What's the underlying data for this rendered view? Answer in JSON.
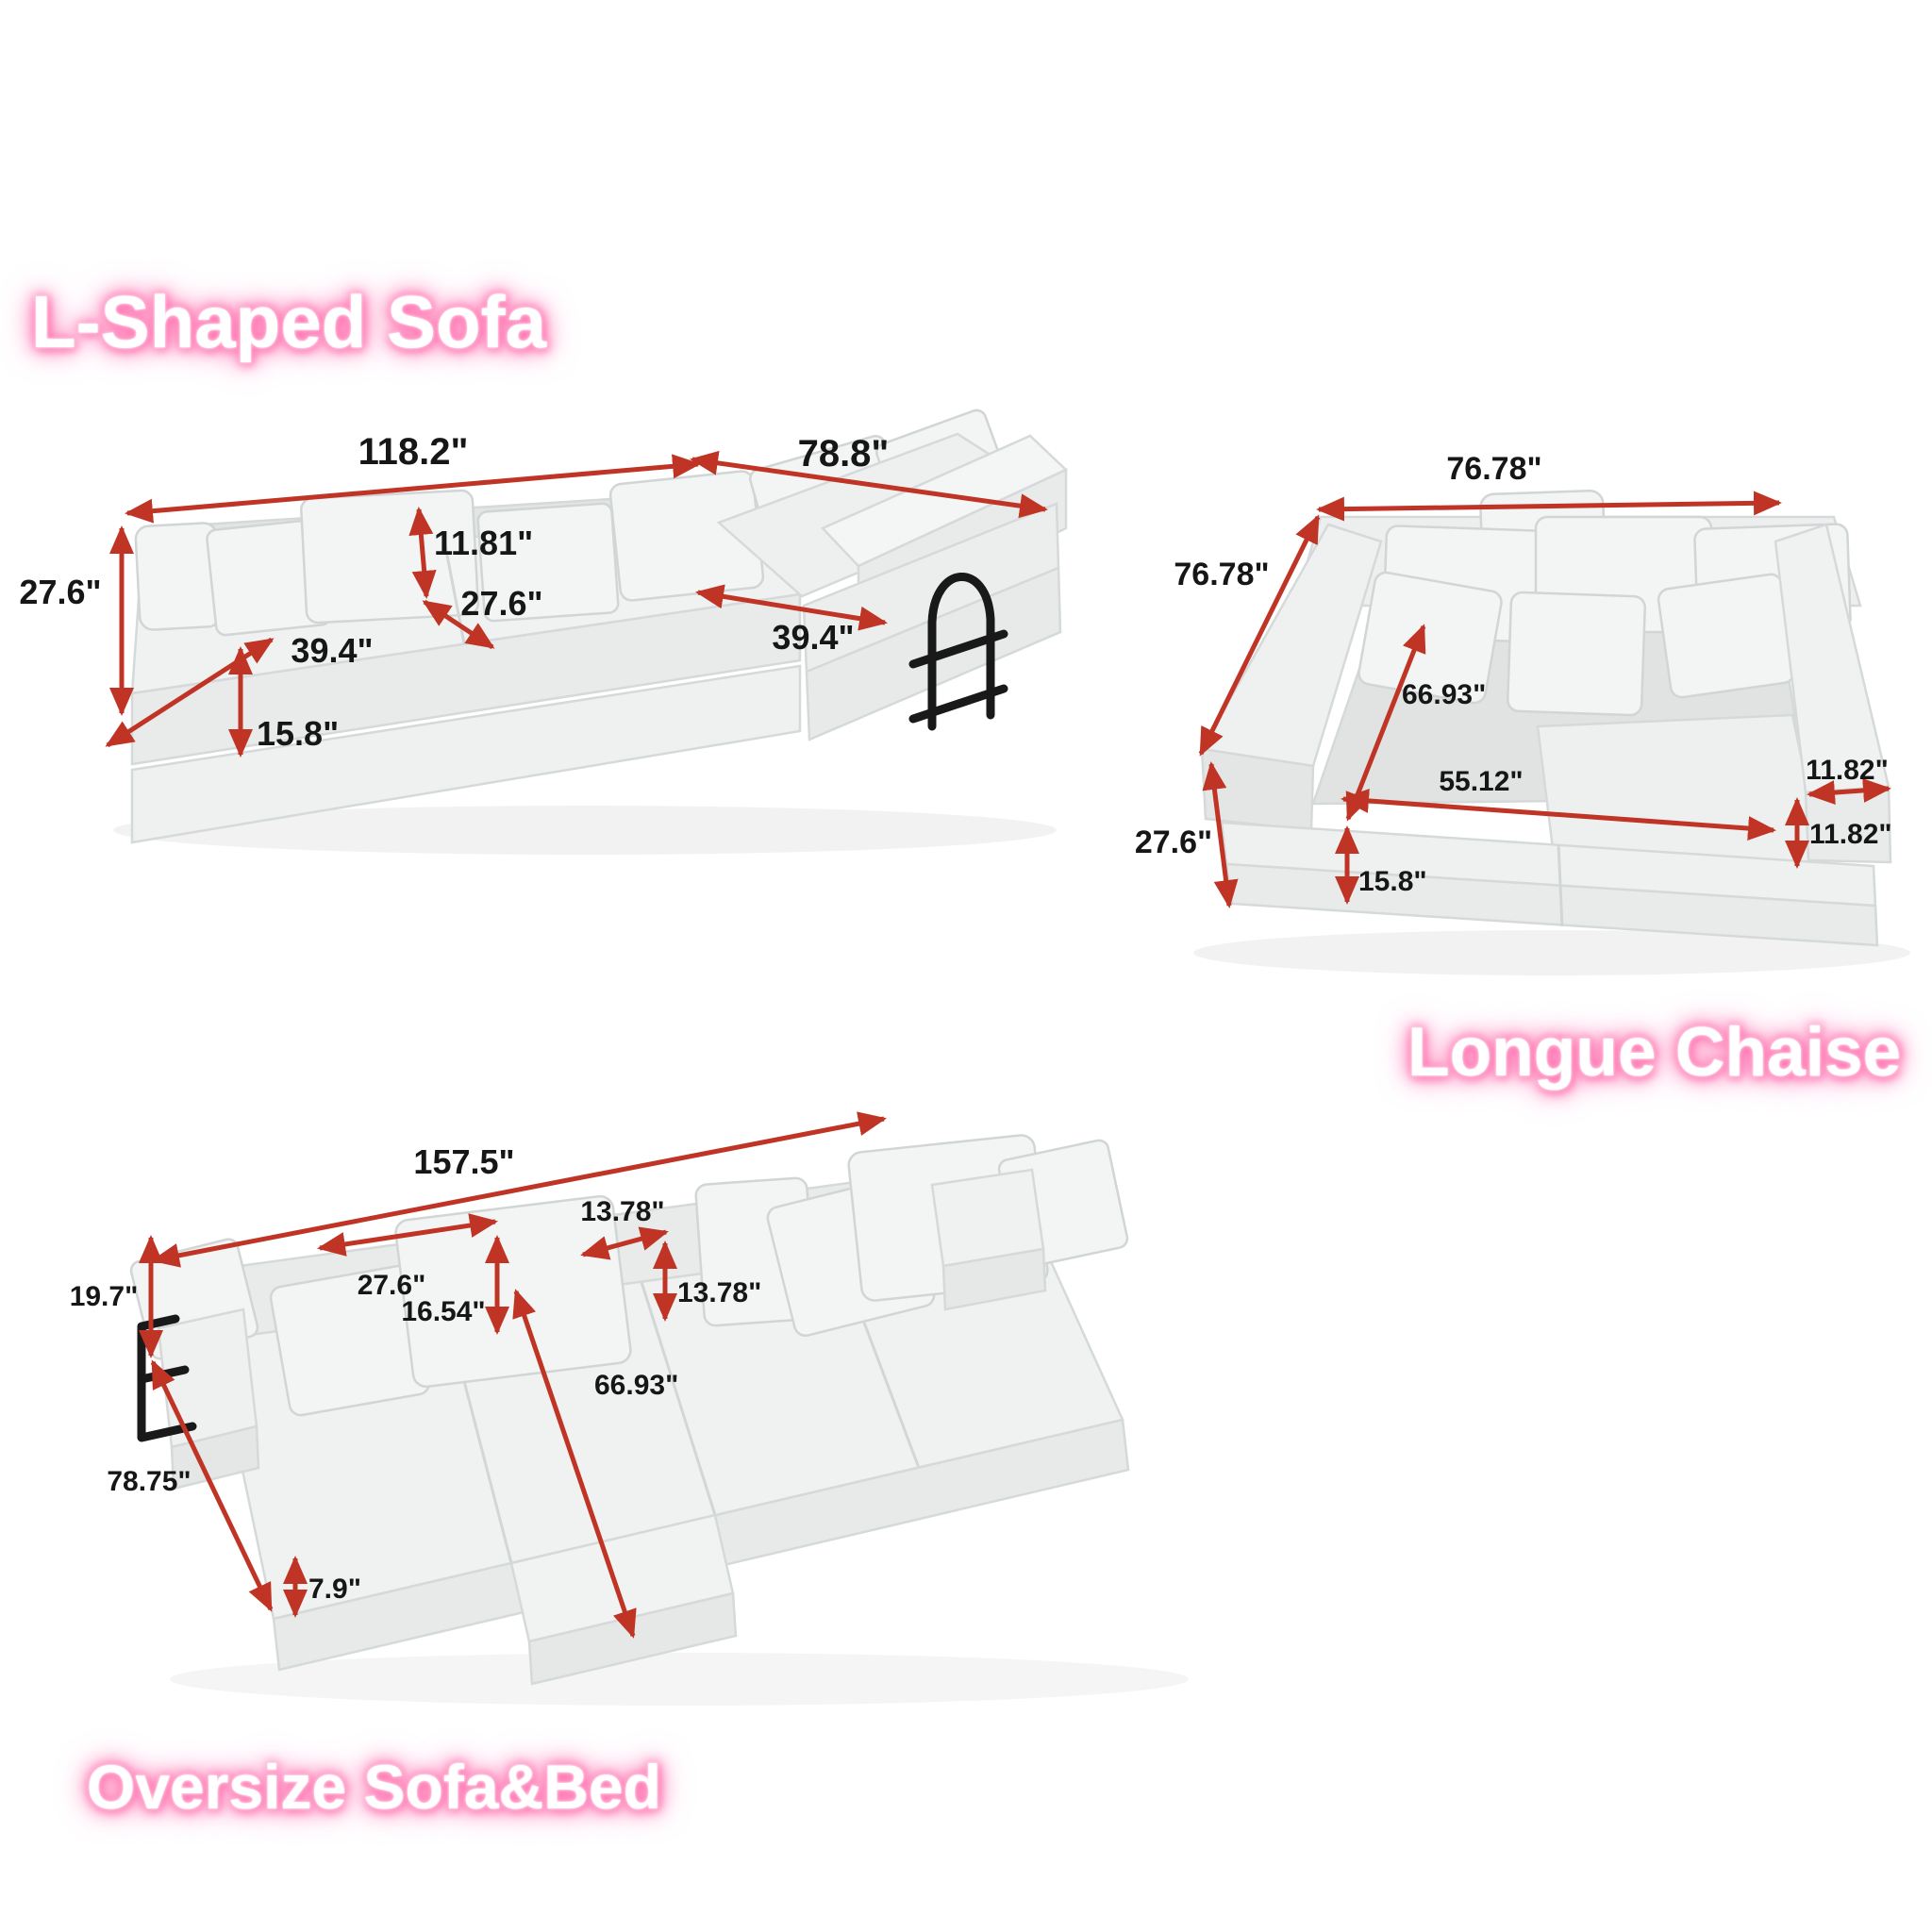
{
  "colors": {
    "background": "#ffffff",
    "arrow": "#c03425",
    "label": "#161616",
    "title_color": "#ffffff",
    "title_glow": "#ff6fae",
    "sofa_fill": "#f0f2f2",
    "sofa_shade": "#e6e8e8"
  },
  "l_shaped": {
    "title": "L-Shaped Sofa",
    "dims": {
      "overall_length": "118.2\"",
      "return_length": "78.8\"",
      "back_cushion_height": "11.81\"",
      "overall_height": "27.6\"",
      "seat_depth": "27.6\"",
      "seat_width": "39.4\"",
      "chaise_seat_width": "39.4\"",
      "base_height": "15.8\""
    }
  },
  "longue_chaise": {
    "title": "Longue Chaise",
    "dims": {
      "overall_width": "76.78\"",
      "overall_depth": "76.78\"",
      "inner_diagonal": "66.93\"",
      "inner_width": "55.12\"",
      "armrest_width": "11.82\"",
      "armrest_height": "11.82\"",
      "overall_height": "27.6\"",
      "base_height": "15.8\""
    }
  },
  "oversize": {
    "title": "Oversize Sofa&Bed",
    "dims": {
      "overall_length": "157.5\"",
      "back_cushion_width": "27.6\"",
      "back_cushion_height": "16.54\"",
      "small_cushion_width": "13.78\"",
      "small_cushion_height": "13.78\"",
      "back_height": "19.7\"",
      "bed_diagonal": "66.93\"",
      "overall_depth": "78.75\"",
      "mattress_height": "7.9\""
    }
  }
}
